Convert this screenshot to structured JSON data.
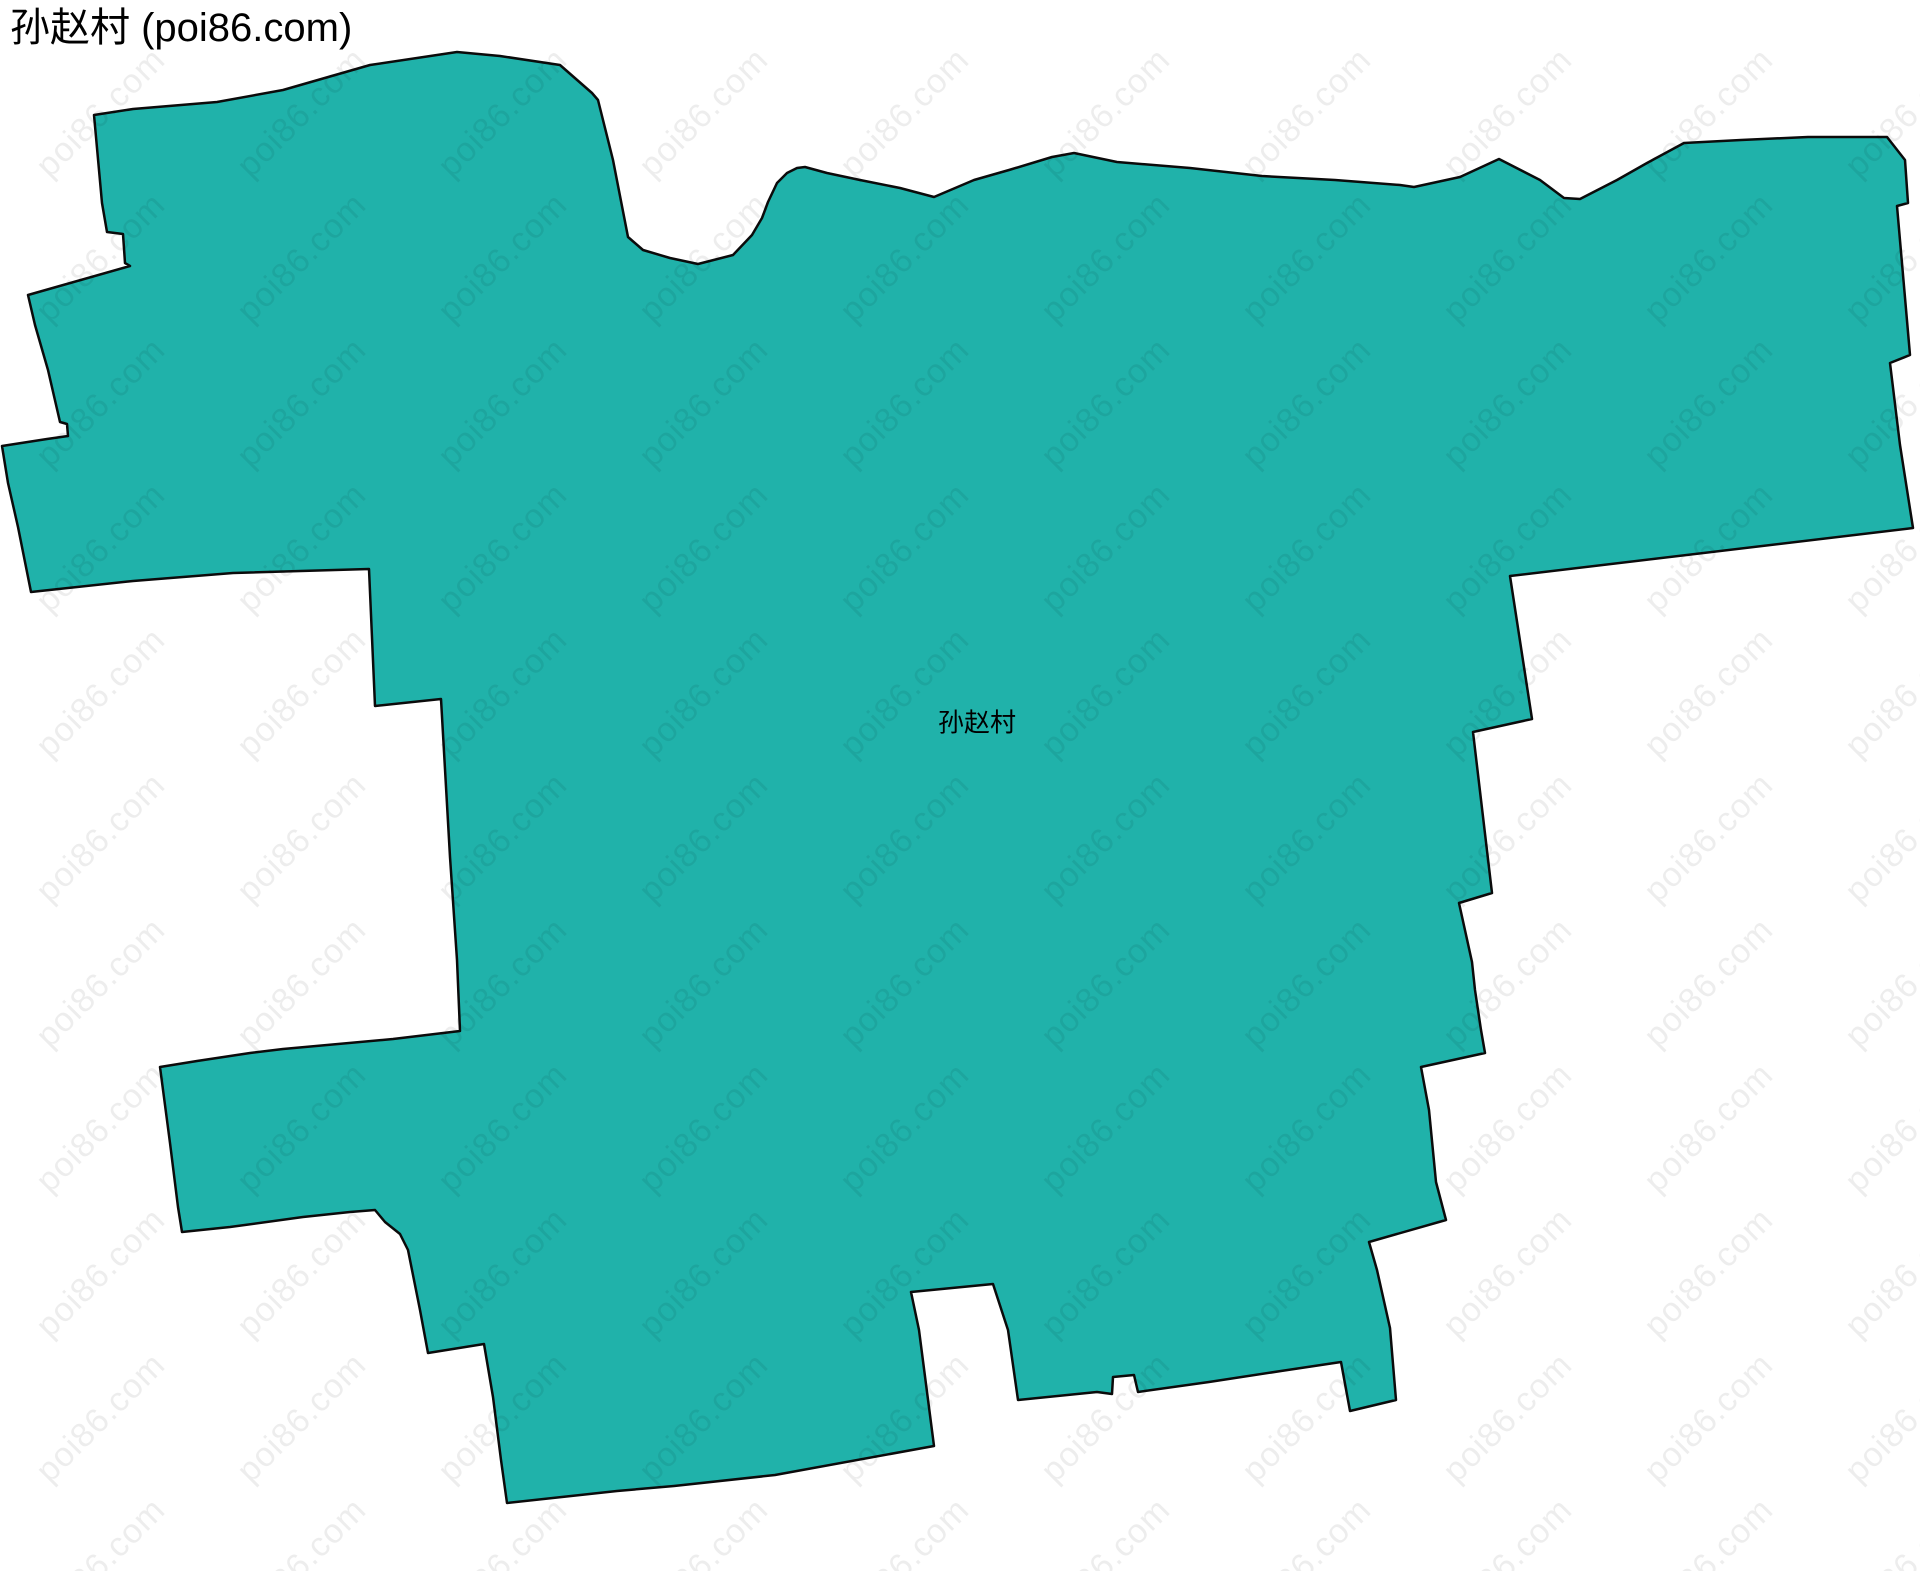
{
  "page": {
    "width": 1920,
    "height": 1571,
    "background": "#ffffff"
  },
  "header": {
    "title": "孙赵村 (poi86.com)"
  },
  "map": {
    "region_label": "孙赵村",
    "label_position": {
      "x": 977,
      "y": 721
    },
    "fill_color": "#20B2AA",
    "border_color": "#0b0b0b",
    "border_width": 2.5,
    "polygon_points": [
      [
        94,
        115
      ],
      [
        102,
        203
      ],
      [
        107,
        232
      ],
      [
        123,
        234
      ],
      [
        125,
        263
      ],
      [
        130,
        266
      ],
      [
        28,
        295
      ],
      [
        35,
        325
      ],
      [
        48,
        370
      ],
      [
        60,
        422
      ],
      [
        67,
        424
      ],
      [
        68,
        436
      ],
      [
        47,
        439
      ],
      [
        2,
        446
      ],
      [
        8,
        483
      ],
      [
        18,
        527
      ],
      [
        31,
        592
      ],
      [
        133,
        581
      ],
      [
        233,
        573
      ],
      [
        369,
        569
      ],
      [
        375,
        706
      ],
      [
        441,
        699
      ],
      [
        450,
        857
      ],
      [
        457,
        960
      ],
      [
        460,
        1031
      ],
      [
        393,
        1039
      ],
      [
        283,
        1049
      ],
      [
        250,
        1053
      ],
      [
        197,
        1061
      ],
      [
        160,
        1067
      ],
      [
        170,
        1143
      ],
      [
        178,
        1207
      ],
      [
        182,
        1232
      ],
      [
        230,
        1227
      ],
      [
        303,
        1217
      ],
      [
        350,
        1212
      ],
      [
        375,
        1210
      ],
      [
        385,
        1222
      ],
      [
        400,
        1234
      ],
      [
        408,
        1250
      ],
      [
        420,
        1310
      ],
      [
        428,
        1353
      ],
      [
        484,
        1344
      ],
      [
        493,
        1397
      ],
      [
        501,
        1460
      ],
      [
        507,
        1503
      ],
      [
        617,
        1491
      ],
      [
        674,
        1486
      ],
      [
        775,
        1475
      ],
      [
        934,
        1446
      ],
      [
        919,
        1330
      ],
      [
        911,
        1292
      ],
      [
        993,
        1284
      ],
      [
        1008,
        1330
      ],
      [
        1018,
        1400
      ],
      [
        1097,
        1392
      ],
      [
        1112,
        1394
      ],
      [
        1113,
        1377
      ],
      [
        1134,
        1375
      ],
      [
        1138,
        1392
      ],
      [
        1209,
        1382
      ],
      [
        1281,
        1371
      ],
      [
        1341,
        1362
      ],
      [
        1350,
        1411
      ],
      [
        1396,
        1400
      ],
      [
        1390,
        1328
      ],
      [
        1377,
        1270
      ],
      [
        1369,
        1242
      ],
      [
        1446,
        1220
      ],
      [
        1436,
        1182
      ],
      [
        1429,
        1110
      ],
      [
        1421,
        1067
      ],
      [
        1485,
        1053
      ],
      [
        1481,
        1030
      ],
      [
        1475,
        990
      ],
      [
        1472,
        962
      ],
      [
        1459,
        903
      ],
      [
        1492,
        893
      ],
      [
        1473,
        732
      ],
      [
        1532,
        719
      ],
      [
        1510,
        576
      ],
      [
        1913,
        528
      ],
      [
        1900,
        445
      ],
      [
        1890,
        363
      ],
      [
        1910,
        355
      ],
      [
        1897,
        206
      ],
      [
        1908,
        203
      ],
      [
        1905,
        160
      ],
      [
        1887,
        137
      ],
      [
        1808,
        137
      ],
      [
        1741,
        140
      ],
      [
        1684,
        143
      ],
      [
        1647,
        163
      ],
      [
        1617,
        180
      ],
      [
        1580,
        199
      ],
      [
        1564,
        198
      ],
      [
        1540,
        180
      ],
      [
        1499,
        159
      ],
      [
        1460,
        177
      ],
      [
        1414,
        187
      ],
      [
        1400,
        185
      ],
      [
        1335,
        180
      ],
      [
        1298,
        178
      ],
      [
        1262,
        176
      ],
      [
        1226,
        172
      ],
      [
        1190,
        168
      ],
      [
        1117,
        162
      ],
      [
        1074,
        153
      ],
      [
        1052,
        157
      ],
      [
        1009,
        170
      ],
      [
        974,
        180
      ],
      [
        934,
        197
      ],
      [
        900,
        188
      ],
      [
        860,
        180
      ],
      [
        827,
        173
      ],
      [
        805,
        167
      ],
      [
        797,
        168
      ],
      [
        787,
        173
      ],
      [
        777,
        183
      ],
      [
        768,
        202
      ],
      [
        762,
        218
      ],
      [
        752,
        235
      ],
      [
        733,
        255
      ],
      [
        698,
        264
      ],
      [
        670,
        258
      ],
      [
        643,
        250
      ],
      [
        628,
        237
      ],
      [
        613,
        160
      ],
      [
        598,
        100
      ],
      [
        592,
        93
      ],
      [
        560,
        65
      ],
      [
        500,
        56
      ],
      [
        457,
        52
      ],
      [
        370,
        65
      ],
      [
        283,
        90
      ],
      [
        217,
        102
      ],
      [
        133,
        109
      ]
    ]
  },
  "watermark": {
    "text": "poi86.com",
    "color": "rgba(0,0,0,0.07)",
    "font_size": 34,
    "rotation_deg": -45,
    "origin_x": 101,
    "origin_y": 113,
    "col_spacing": 201,
    "row_spacing": 145,
    "cols": 10,
    "rows": 11
  }
}
